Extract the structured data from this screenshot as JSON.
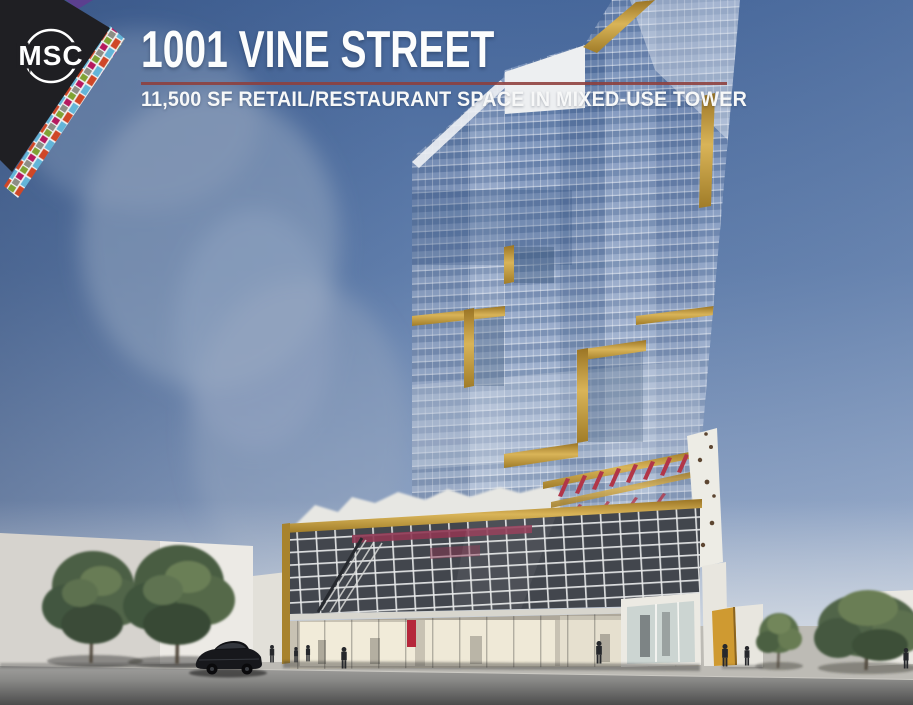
{
  "page": {
    "width": 913,
    "height": 705,
    "kind": "commercial real estate flyer"
  },
  "logo": {
    "text": "MSC"
  },
  "header": {
    "title": "1001 VINE STREET",
    "subtitle": "11,500 SF RETAIL/RESTAURANT SPACE IN MIXED-USE TOWER"
  },
  "palette": {
    "title_white": "#fcfdfd",
    "divider_red": "#8e3f3b",
    "logo_black": "#1f1f23",
    "gold_accent": "#c9a23f",
    "sky_top": "#46679b",
    "sky_horizon": "#c0cad8",
    "glass_blue": "#869cc1",
    "street_gray": "#8a8a88",
    "tree_green": "#4b5e44",
    "mosaic_colors": [
      "#cf4727",
      "#63b5d8",
      "#7fa233",
      "#8d8d85",
      "#b5195f",
      "#5b3f8f",
      "#ffffff"
    ]
  },
  "scene": {
    "elements": [
      "glass mixed-use tower with gold accents",
      "rooftop trellis with plantings",
      "retail/restaurant podium with parking levels",
      "glass storefronts",
      "street trees",
      "parked car",
      "pedestrians",
      "neighboring white buildings",
      "street and sidewalk"
    ]
  }
}
